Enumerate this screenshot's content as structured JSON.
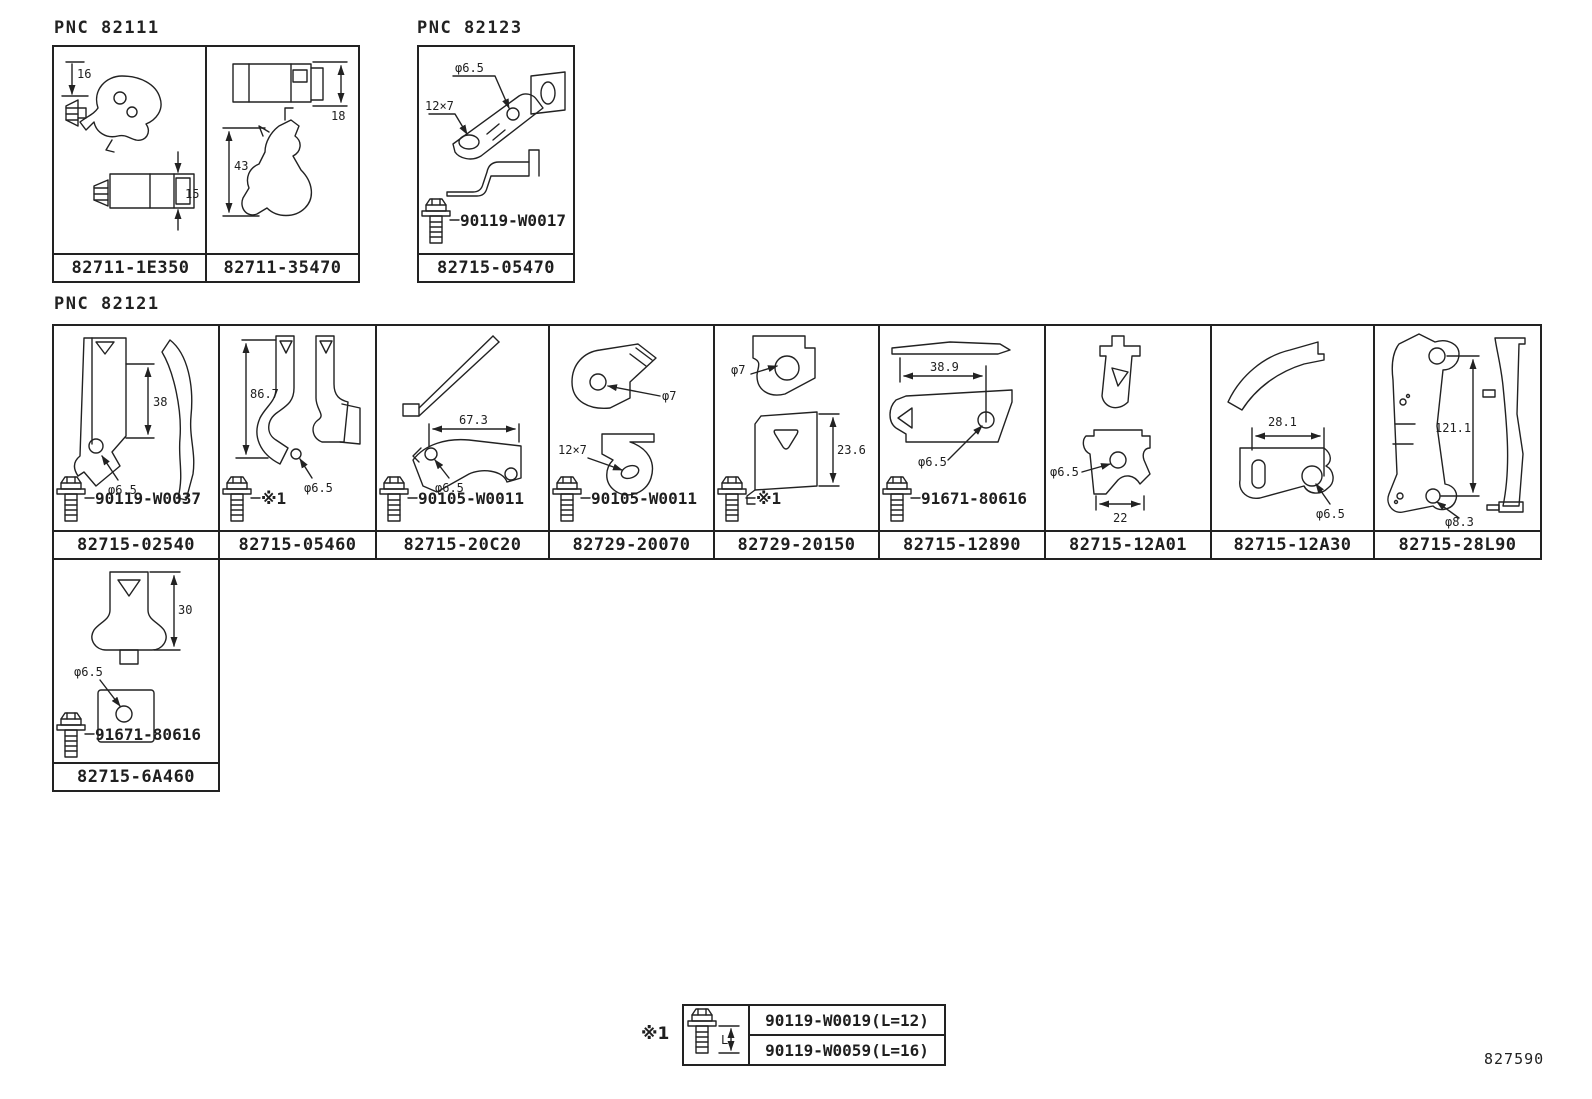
{
  "doc_number": "827590",
  "groups": {
    "g82111": {
      "label": "PNC 82111",
      "cells": [
        {
          "part": "82711-1E350",
          "dims": {
            "d1": "16",
            "d2": "15"
          }
        },
        {
          "part": "82711-35470",
          "dims": {
            "d1": "18",
            "d2": "43"
          }
        }
      ]
    },
    "g82123": {
      "label": "PNC 82123",
      "cells": [
        {
          "part": "82715-05470",
          "dims": {
            "d1": "φ6.5",
            "d2": "12×7"
          },
          "fastener": "90119-W0017"
        }
      ]
    },
    "g82121": {
      "label": "PNC 82121",
      "cells": [
        {
          "part": "82715-02540",
          "dims": {
            "d1": "38",
            "d2": "φ6.5"
          },
          "fastener": "90119-W0037"
        },
        {
          "part": "82715-05460",
          "dims": {
            "d1": "86.7",
            "d2": "φ6.5"
          },
          "fastener": "※1"
        },
        {
          "part": "82715-20C20",
          "dims": {
            "d1": "67.3",
            "d2": "φ6.5"
          },
          "fastener": "90105-W0011"
        },
        {
          "part": "82729-20070",
          "dims": {
            "d1": "φ7",
            "d2": "12×7"
          },
          "fastener": "90105-W0011"
        },
        {
          "part": "82729-20150",
          "dims": {
            "d1": "φ7",
            "d2": "23.6"
          },
          "fastener": "※1"
        },
        {
          "part": "82715-12890",
          "dims": {
            "d1": "38.9",
            "d2": "φ6.5"
          },
          "fastener": "91671-80616"
        },
        {
          "part": "82715-12A01",
          "dims": {
            "d1": "φ6.5",
            "d2": "22"
          }
        },
        {
          "part": "82715-12A30",
          "dims": {
            "d1": "28.1",
            "d2": "φ6.5"
          }
        },
        {
          "part": "82715-28L90",
          "dims": {
            "d1": "121.1",
            "d2": "φ8.3"
          }
        }
      ]
    },
    "g6a460": {
      "cells": [
        {
          "part": "82715-6A460",
          "dims": {
            "d1": "30",
            "d2": "φ6.5"
          },
          "fastener": "91671-80616"
        }
      ]
    }
  },
  "note_table": {
    "marker": "※1",
    "bolt_dim": "L",
    "rows": [
      {
        "part_spec": "90119-W0019(L=12)"
      },
      {
        "part_spec": "90119-W0059(L=16)"
      }
    ]
  }
}
